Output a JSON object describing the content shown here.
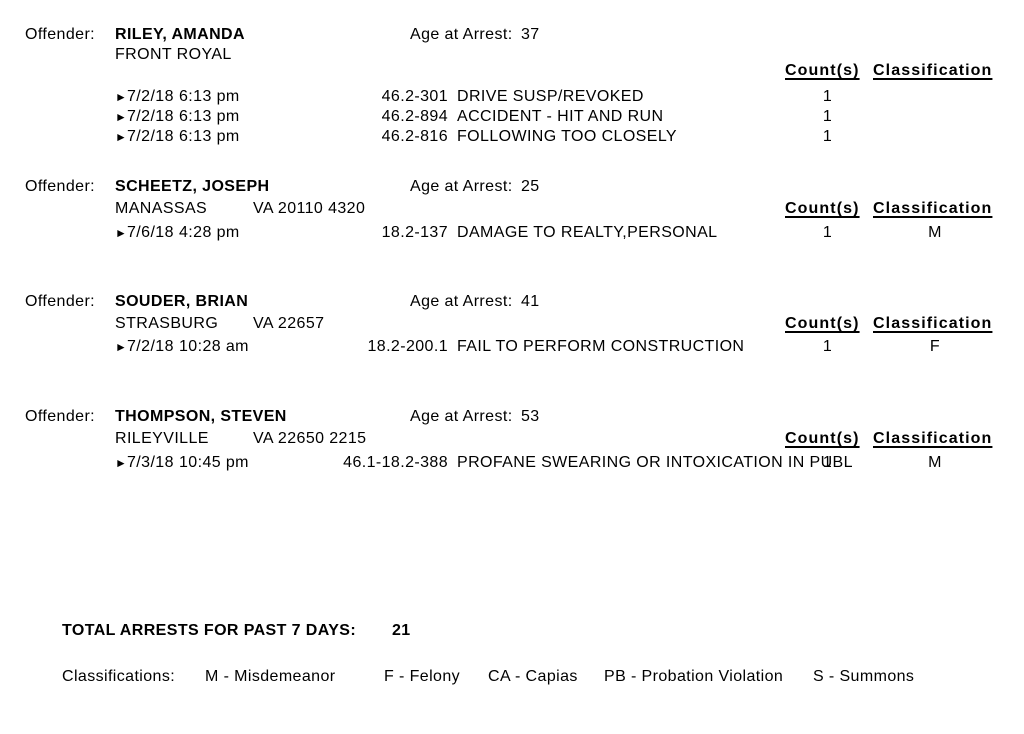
{
  "labels": {
    "offender": "Offender:",
    "age_at_arrest": "Age at Arrest:",
    "count_header": "Count(s)",
    "classification_header": "Classification",
    "bullet": "►"
  },
  "offenders": [
    {
      "name": "RILEY, AMANDA",
      "city": "FRONT ROYAL",
      "state_zip": "",
      "age": "37",
      "charges": [
        {
          "date": "7/2/18",
          "time": "6:13 pm",
          "code": "46.2-301",
          "offense": "DRIVE SUSP/REVOKED",
          "count": "1",
          "classification": ""
        },
        {
          "date": "7/2/18",
          "time": "6:13 pm",
          "code": "46.2-894",
          "offense": "ACCIDENT - HIT AND RUN",
          "count": "1",
          "classification": ""
        },
        {
          "date": "7/2/18",
          "time": "6:13 pm",
          "code": "46.2-816",
          "offense": "FOLLOWING TOO CLOSELY",
          "count": "1",
          "classification": ""
        }
      ]
    },
    {
      "name": "SCHEETZ, JOSEPH",
      "city": "MANASSAS",
      "state_zip": "VA 20110 4320",
      "age": "25",
      "charges": [
        {
          "date": "7/6/18",
          "time": "4:28 pm",
          "code": "18.2-137",
          "offense": "DAMAGE TO REALTY,PERSONAL",
          "count": "1",
          "classification": "M"
        }
      ]
    },
    {
      "name": "SOUDER, BRIAN",
      "city": "STRASBURG",
      "state_zip": "VA 22657",
      "age": "41",
      "charges": [
        {
          "date": "7/2/18",
          "time": "10:28 am",
          "code": "18.2-200.1",
          "offense": "FAIL TO PERFORM CONSTRUCTION",
          "count": "1",
          "classification": "F"
        }
      ]
    },
    {
      "name": "THOMPSON, STEVEN",
      "city": "RILEYVILLE",
      "state_zip": "VA 22650 2215",
      "age": "53",
      "charges": [
        {
          "date": "7/3/18",
          "time": "10:45 pm",
          "code": "46.1-18.2-388",
          "offense": "PROFANE SWEARING OR INTOXICATION IN PUBL",
          "count": "1",
          "classification": "M"
        }
      ]
    }
  ],
  "summary": {
    "total_label": "TOTAL ARRESTS FOR PAST 7 DAYS:",
    "total_value": "21"
  },
  "legend": {
    "label": "Classifications:",
    "items": [
      "M - Misdemeanor",
      "F - Felony",
      "CA - Capias",
      "PB - Probation Violation",
      "S - Summons"
    ]
  }
}
